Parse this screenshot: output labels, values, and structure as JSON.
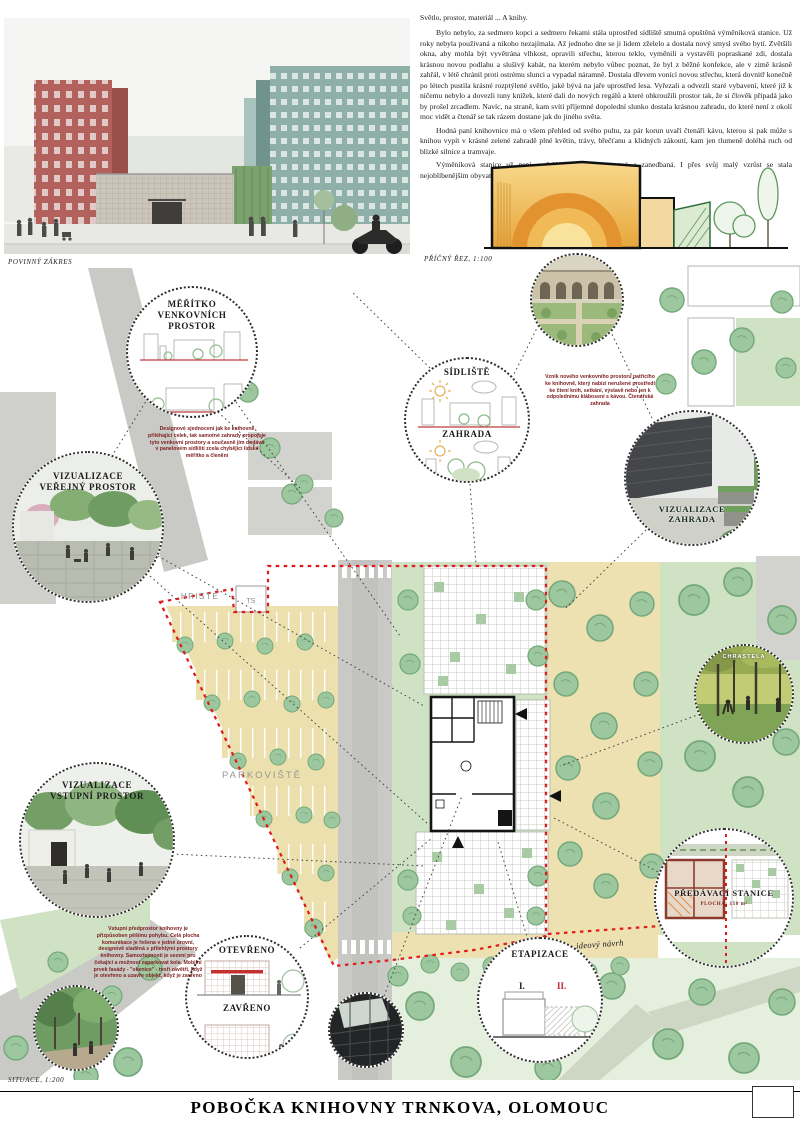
{
  "labels": {
    "povinny_zakres": "POVINNÝ ZÁKRES",
    "pricny_rez": "PŘÍČNÝ ŘEZ, 1:100",
    "situace": "SITUACE, 1:200",
    "title": "POBOČKA KNIHOVNY TRNKOVA, OLOMOUC"
  },
  "story": {
    "title": "Světlo, prostor, materiál ... A knihy.",
    "paragraphs": [
      "Bylo nebylo, za sedmero kopci a sedmero řekami stála uprostřed sídliště smutná opuštěná výměníková stanice. Už roky nebyla používaná a nikoho nezajímala. Až jednoho dne se ji lidem zželelo a dostala nový smysl svého bytí. Zvětšili okna, aby mohla být vyvětrána vlhkost, opravili střechu, kterou teklo, vyměnili a vystavěli popraskané zdi, dostala krásnou novou podlahu a slušivý kabát, na kterém nebylo vůbec poznat, že byl z běžné konfekce, ale v zimě krásně zahřál, v létě chránil proti ostrému slunci a vypadal náramně. Dostala dřevem vonící novou střechu, která dovnitř konečně po létech pustila krásné rozptýlené světlo, jaké bývá na jaře uprostřed lesa. Vyřezali a odvezli staré vybavení, které již k ničemu nebylo a dovezli tuny knížek, které dali do nových regálů a které obkroužili prostor tak, že si člověk připadá jako by prošel zrcadlem. Navíc, na straně, kam svítí příjemné dopolední slunko dostala krásnou zahradu, do které není z okolí moc vidět a čtenář se tak rázem dostane jak do jiného světa.",
      "Hodná paní knihovnice má o všem přehled od svého pultu, za pár korun uvaří čtenáři kávu, kterou si pak může s knihou vypít v krásné zelené zahradě plné květin, trávy, břečťanu a klidných zákoutí, kam jen tlumeně doléhá ruch od blízké silnice a tramvaje.",
      "Výměníková stanice už není omšelá, popraskaná, smutná a zanedbaná. I přes svůj malý vzrůst se stala nejoblíbenějším obyvatelem své čtvrti."
    ]
  },
  "plan": {
    "parkoviste": "PARKOVIŠTĚ",
    "hriste": "HRISTE",
    "ts": "TS",
    "handwritten_note": "ideový návrh"
  },
  "callouts": {
    "meritko": {
      "l1": "MĚŘÍTKO",
      "l2": "VENKOVNÍCH",
      "l3": "PROSTOR"
    },
    "verejny": {
      "l1": "VIZUALIZACE",
      "l2": "VEŘEJNÝ PROSTOR"
    },
    "sidliste": {
      "top": "SÍDLIŠTĚ",
      "bottom": "ZAHRADA"
    },
    "viz_zahrada": {
      "l1": "VIZUALIZACE",
      "l2": "ZAHRADA"
    },
    "vstupni": {
      "l1": "VIZUALIZACE",
      "l2": "VSTUPNÍ PROSTOR"
    },
    "otevreno_zavreno": {
      "open": "OTEVŘENO",
      "closed": "ZAVŘENO"
    },
    "etapizace": {
      "label": "ETAPIZACE",
      "stage1": "I.",
      "stage2": "II."
    },
    "predavaci": {
      "l1": "PŘEDÁVACÍ STANICE",
      "l2": "PLOCHA: 150 m²"
    },
    "park_photo_caption": "CHRASTELA"
  },
  "annotations": {
    "design_note": "Designové sjednocení jak ke knihovně přiléhající celek, tak samotné zahrady propojuje tyto venkovní prostory a současně jim dodává v panelovém sídlišti zcela chybějící lidské měřítko a členění",
    "garden_note": "Vznik nového venkovního prostoru patřícího ke knihovně, který nabízí nerušené prostředí ke čtení knih, setkání, výstavě nebo jen k odpolednímu klábosení s kávou. Čtenářská zahrada",
    "entry_note": "Vstupní předprostor knihovny je přizpůsoben pěšímu pohybu. Celá plocha komunikace je řešena v jedné úrovni, designově sladěná s přilehlými prostory knihovny. Samozřejmostí je sezení pro čekající a možnost zaparkovat kola. Mobilní prvek fasády - \"okenice\" - tvoří závětří, když je otevřeno a uzavře objekt, když je zavřeno"
  },
  "colors": {
    "site_boundary": "#e11919",
    "annotation_text": "#7e1d1d",
    "grass": "#cfe2c3",
    "paving_sand": "#ede1b2",
    "road": "#c9cac6",
    "tree": "#9dc79e",
    "section_interior": "#e8a63c"
  }
}
